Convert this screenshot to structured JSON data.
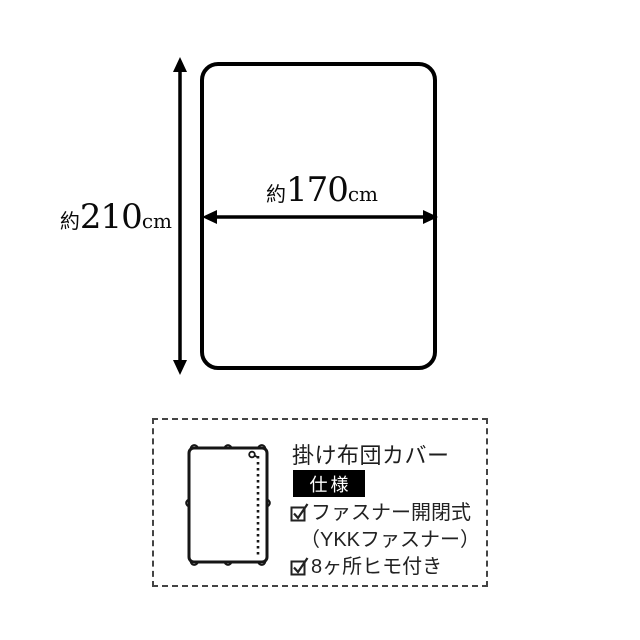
{
  "colors": {
    "ink": "#000000",
    "text": "#222222",
    "badge_bg": "#000000",
    "badge_text": "#ffffff",
    "background": "#ffffff"
  },
  "dimension_diagram": {
    "height": {
      "prefix": "約",
      "value": "210",
      "unit": "cm"
    },
    "width": {
      "prefix": "約",
      "value": "170",
      "unit": "cm"
    }
  },
  "spec_box": {
    "title": "掛け布団カバー",
    "badge_label": "仕様",
    "features": [
      {
        "checked": true,
        "label": "ファスナー開閉式"
      },
      {
        "checked": false,
        "label": "（YKKファスナー）"
      },
      {
        "checked": true,
        "label": "8ヶ所ヒモ付き"
      }
    ]
  }
}
